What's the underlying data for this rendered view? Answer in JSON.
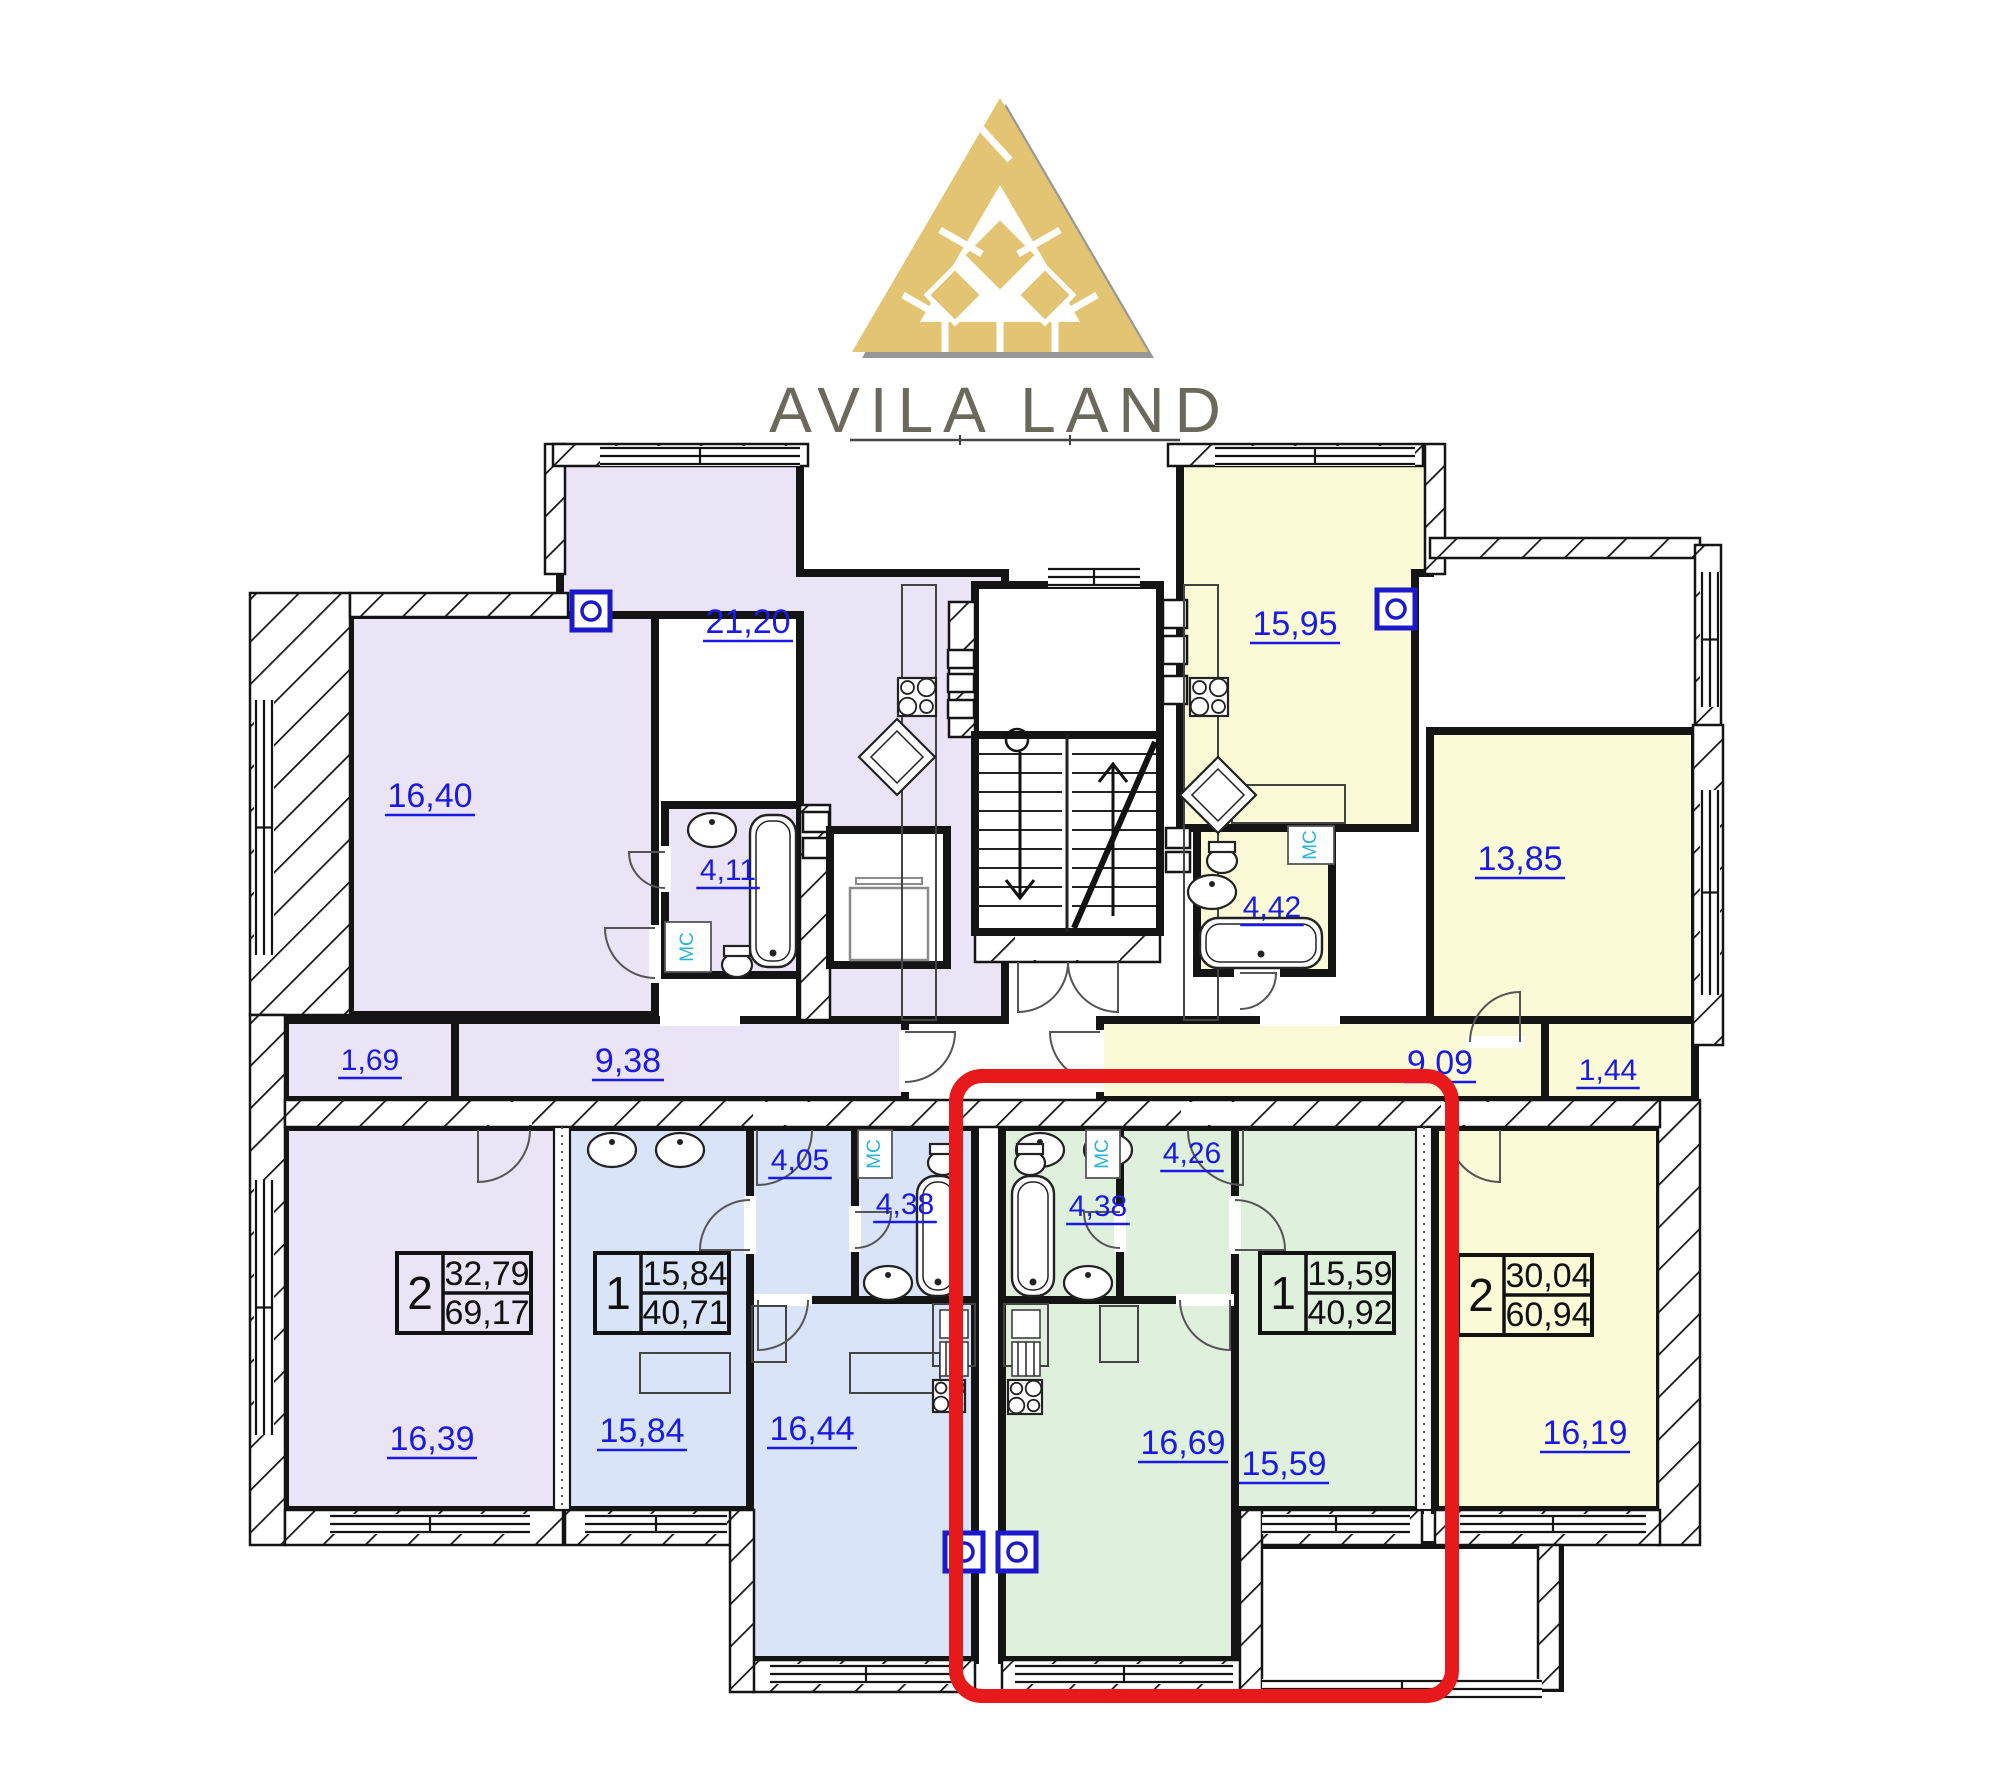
{
  "brand": {
    "name": "AVILA LAND"
  },
  "palette": {
    "purple": "#EBE3F6",
    "blue": "#D9E4F8",
    "green": "#DFF1DC",
    "yellow": "#FAFAD7",
    "white": "#FFFFFF",
    "wall": "#141414",
    "label_blue": "#1A1AE6",
    "mc_cyan": "#2BB3D8",
    "vent_blue": "#1A1ACC",
    "red": "#E8191B",
    "gold": "#E2C472",
    "gold_shadow": "#979797",
    "brand_text": "#6B695C",
    "fixture": "#2A2A2A"
  },
  "highlighted_apartment": {
    "rooms": "1",
    "living_area": "15,59",
    "total_area": "40,92",
    "color": "green"
  },
  "plan": {
    "rooms": [
      {
        "name": "kitchen-living-21-20",
        "fill": "purple",
        "poly": [
          [
            560,
            455
          ],
          [
            800,
            455
          ],
          [
            800,
            573
          ],
          [
            1005,
            573
          ],
          [
            1005,
            1020
          ],
          [
            800,
            1020
          ],
          [
            800,
            615
          ],
          [
            560,
            615
          ]
        ]
      },
      {
        "name": "kitchen-living-15-95",
        "fill": "yellow",
        "poly": [
          [
            1180,
            455
          ],
          [
            1430,
            455
          ],
          [
            1430,
            573
          ],
          [
            1415,
            573
          ],
          [
            1415,
            828
          ],
          [
            1180,
            828
          ]
        ]
      },
      {
        "name": "room-16-40",
        "fill": "purple",
        "rect": [
          350,
          615,
          305,
          400
        ]
      },
      {
        "name": "room-13-85",
        "fill": "yellow",
        "rect": [
          1430,
          731,
          265,
          311
        ]
      },
      {
        "name": "room-16-39",
        "fill": "purple",
        "rect": [
          285,
          1127,
          278,
          383
        ]
      },
      {
        "name": "room-16-19",
        "fill": "yellow",
        "rect": [
          1435,
          1127,
          225,
          383
        ]
      },
      {
        "name": "bedroom-15-84",
        "fill": "blue",
        "rect": [
          565,
          1127,
          185,
          383
        ]
      },
      {
        "name": "kitchen-16-44",
        "fill": "blue",
        "rect": [
          750,
          1127,
          225,
          533
        ]
      },
      {
        "name": "kitchen-16-69",
        "fill": "green",
        "rect": [
          1002,
          1127,
          233,
          533
        ]
      },
      {
        "name": "bedroom-15-59",
        "fill": "green",
        "rect": [
          1235,
          1127,
          185,
          383
        ]
      },
      {
        "name": "hall-9-38",
        "fill": "purple",
        "rect": [
          455,
          1020,
          450,
          80
        ]
      },
      {
        "name": "closet-1-69",
        "fill": "purple",
        "rect": [
          285,
          1020,
          170,
          80
        ]
      },
      {
        "name": "hall-9-09",
        "fill": "yellow",
        "rect": [
          1100,
          1020,
          445,
          80
        ]
      },
      {
        "name": "closet-1-44",
        "fill": "yellow",
        "rect": [
          1545,
          1020,
          150,
          80
        ]
      },
      {
        "name": "hall-4-05",
        "fill": "blue",
        "rect": [
          750,
          1127,
          105,
          173
        ]
      },
      {
        "name": "bath-4-11",
        "fill": "purple",
        "rect": [
          665,
          805,
          135,
          170
        ]
      },
      {
        "name": "bath-4-42",
        "fill": "yellow",
        "rect": [
          1197,
          828,
          135,
          145
        ]
      },
      {
        "name": "bath-4-38-blue",
        "fill": "blue",
        "rect": [
          855,
          1127,
          120,
          173
        ]
      },
      {
        "name": "bath-4-38-green",
        "fill": "green",
        "rect": [
          1002,
          1127,
          118,
          173
        ]
      },
      {
        "name": "hall-4-26",
        "fill": "green",
        "rect": [
          1120,
          1127,
          115,
          173
        ]
      },
      {
        "name": "vestibule",
        "fill": "white",
        "rect": [
          975,
          585,
          185,
          150
        ]
      },
      {
        "name": "stairwell",
        "fill": "white",
        "rect": [
          975,
          735,
          185,
          197
        ]
      },
      {
        "name": "terrace",
        "fill": "white",
        "rect": [
          1250,
          1545,
          310,
          143
        ]
      }
    ],
    "hatched_walls": [
      [
        250,
        593,
        100,
        422
      ],
      [
        250,
        1015,
        35,
        530
      ],
      [
        285,
        1510,
        278,
        35
      ],
      [
        350,
        593,
        218,
        24
      ],
      [
        545,
        444,
        20,
        130
      ],
      [
        553,
        444,
        255,
        22
      ],
      [
        1168,
        444,
        255,
        22
      ],
      [
        1425,
        444,
        20,
        130
      ],
      [
        949,
        602,
        26,
        135
      ],
      [
        1430,
        538,
        270,
        20
      ],
      [
        1695,
        545,
        26,
        188
      ],
      [
        1693,
        725,
        30,
        320
      ],
      [
        1658,
        1100,
        42,
        445
      ],
      [
        1435,
        1510,
        225,
        35
      ],
      [
        1250,
        1510,
        172,
        35
      ],
      [
        565,
        1510,
        187,
        35
      ],
      [
        753,
        1660,
        222,
        32
      ],
      [
        1002,
        1660,
        244,
        32
      ],
      [
        730,
        1510,
        24,
        182
      ],
      [
        1240,
        1510,
        22,
        182
      ],
      [
        1538,
        1545,
        22,
        145
      ],
      [
        285,
        1100,
        1375,
        27
      ],
      [
        975,
        932,
        185,
        30
      ],
      [
        800,
        805,
        30,
        215
      ]
    ],
    "door_gaps": [
      [
        472,
        1102,
        60,
        23
      ],
      [
        753,
        1102,
        62,
        23
      ],
      [
        1181,
        1102,
        62,
        23
      ],
      [
        1441,
        1102,
        62,
        23
      ],
      [
        1015,
        934,
        105,
        26
      ],
      [
        899,
        1030,
        10,
        62
      ],
      [
        1094,
        1030,
        10,
        62
      ],
      [
        660,
        1012,
        80,
        14
      ],
      [
        1260,
        1012,
        80,
        14
      ],
      [
        649,
        925,
        12,
        58
      ],
      [
        1466,
        1036,
        58,
        12
      ],
      [
        744,
        1196,
        12,
        58
      ],
      [
        1229,
        1196,
        12,
        58
      ],
      [
        754,
        1294,
        58,
        12
      ],
      [
        1176,
        1294,
        58,
        12
      ],
      [
        849,
        1206,
        12,
        46
      ],
      [
        1114,
        1206,
        12,
        46
      ],
      [
        659,
        846,
        12,
        46
      ],
      [
        1234,
        967,
        46,
        12
      ],
      [
        1030,
        729,
        70,
        12
      ]
    ],
    "windows": [
      {
        "o": "h",
        "x": 600,
        "y": 446,
        "len": 200
      },
      {
        "o": "h",
        "x": 1215,
        "y": 446,
        "len": 200
      },
      {
        "o": "h",
        "x": 1048,
        "y": 567,
        "len": 92
      },
      {
        "o": "h",
        "x": 330,
        "y": 1514,
        "len": 200
      },
      {
        "o": "h",
        "x": 585,
        "y": 1514,
        "len": 142
      },
      {
        "o": "h",
        "x": 770,
        "y": 1664,
        "len": 192
      },
      {
        "o": "h",
        "x": 1015,
        "y": 1664,
        "len": 218
      },
      {
        "o": "h",
        "x": 1262,
        "y": 1514,
        "len": 148
      },
      {
        "o": "h",
        "x": 1460,
        "y": 1514,
        "len": 186
      },
      {
        "o": "h",
        "x": 1262,
        "y": 1679,
        "len": 280
      },
      {
        "o": "v",
        "x": 254,
        "y": 700,
        "len": 255
      },
      {
        "o": "v",
        "x": 254,
        "y": 1180,
        "len": 255
      },
      {
        "o": "v",
        "x": 1700,
        "y": 790,
        "len": 205
      },
      {
        "o": "v",
        "x": 1700,
        "y": 572,
        "len": 135
      }
    ],
    "dotted_walls": [
      {
        "x": 554,
        "y": 1127,
        "h": 383
      },
      {
        "x": 1416,
        "y": 1127,
        "h": 383
      }
    ],
    "vents": [
      {
        "x": 572,
        "y": 592
      },
      {
        "x": 1377,
        "y": 590
      },
      {
        "x": 945,
        "y": 1533
      },
      {
        "x": 998,
        "y": 1533
      }
    ],
    "shafts": [
      [
        948,
        650,
        26,
        18
      ],
      [
        948,
        674,
        26,
        18
      ],
      [
        948,
        700,
        26,
        18
      ],
      [
        1163,
        600,
        24,
        28
      ],
      [
        1163,
        636,
        24,
        28
      ],
      [
        1163,
        676,
        24,
        28
      ],
      [
        803,
        812,
        26,
        20
      ],
      [
        803,
        838,
        26,
        20
      ],
      [
        1166,
        828,
        24,
        20
      ],
      [
        1166,
        852,
        24,
        20
      ]
    ],
    "stairs": {
      "rect": [
        975,
        735,
        185,
        197
      ],
      "divider_x": 1067,
      "flight1": [
        978,
        1062
      ],
      "flight2": [
        1072,
        1156
      ],
      "step_y0": 754,
      "step_dy": 19,
      "steps": 9,
      "diagonal": [
        1074,
        928,
        1155,
        742
      ],
      "arrow_down": [
        1020,
        752,
        1020,
        898
      ],
      "arrow_up": [
        1113,
        916,
        1113,
        764
      ],
      "circle": [
        1017,
        740,
        11
      ]
    },
    "elevator": {
      "outer": [
        830,
        830,
        117,
        135
      ],
      "car": [
        850,
        888,
        78,
        72
      ],
      "bar": [
        856,
        878,
        66,
        6
      ]
    },
    "furniture": [
      [
        902,
        585,
        34,
        435
      ],
      [
        1184,
        585,
        34,
        435
      ],
      [
        933,
        1304,
        42,
        62
      ],
      [
        1004,
        1304,
        44,
        62
      ],
      [
        752,
        1306,
        34,
        56
      ],
      [
        1100,
        1306,
        38,
        56
      ],
      [
        1232,
        785,
        113,
        38
      ],
      [
        640,
        1353,
        90,
        40
      ],
      [
        850,
        1353,
        90,
        40
      ]
    ],
    "sink_units": [
      [
        940,
        1310,
        28
      ],
      [
        1012,
        1310,
        28
      ]
    ],
    "stoves": [
      [
        898,
        678,
        38
      ],
      [
        1190,
        678,
        38
      ],
      [
        933,
        1380,
        32
      ],
      [
        1008,
        1380,
        34
      ]
    ],
    "diamonds": [
      [
        897,
        757,
        76
      ],
      [
        1218,
        795,
        76
      ]
    ],
    "tubs": [
      {
        "x": 750,
        "y": 815,
        "w": 46,
        "h": 152
      },
      {
        "x": 1200,
        "y": 918,
        "w": 122,
        "h": 50
      },
      {
        "x": 917,
        "y": 1176,
        "w": 42,
        "h": 120
      },
      {
        "x": 1012,
        "y": 1176,
        "w": 42,
        "h": 120
      }
    ],
    "sinks": [
      [
        712,
        830
      ],
      [
        1212,
        892
      ],
      [
        888,
        1283
      ],
      [
        1088,
        1283
      ],
      [
        612,
        1150
      ],
      [
        680,
        1150
      ],
      [
        1040,
        1150
      ],
      [
        1108,
        1150
      ]
    ],
    "toilets": [
      [
        737,
        952
      ],
      [
        1222,
        848
      ],
      [
        943,
        1150
      ],
      [
        1030,
        1150
      ]
    ],
    "mc_boxes": [
      {
        "x": 665,
        "y": 922,
        "w": 46,
        "h": 50
      },
      {
        "x": 1288,
        "y": 826,
        "w": 46,
        "h": 38
      },
      {
        "x": 858,
        "y": 1130,
        "w": 34,
        "h": 48
      },
      {
        "x": 1086,
        "y": 1130,
        "w": 34,
        "h": 48
      }
    ],
    "mc_text": "МС",
    "doors": [
      "M1018,962 L1018,1012 A50,50 0 0 0 1068,962",
      "M1118,962 L1118,1012 A50,50 0 0 1 1068,962",
      "M905,1032 L955,1032 A50,50 0 0 1 905,1082",
      "M1100,1032 L1050,1032 A50,50 0 0 0 1100,1082",
      "M757,1130 L757,1185 A55,55 0 0 0 812,1130",
      "M1243,1130 L1243,1185 A55,55 0 0 1 1188,1130",
      "M478,1130 L478,1182 A52,52 0 0 0 530,1130",
      "M1500,1130 L1500,1182 A52,52 0 0 1 1448,1130",
      "M655,928 L605,928 A50,50 0 0 0 655,978",
      "M1520,1042 L1520,992 A50,50 0 0 0 1470,1042",
      "M750,1250 L700,1250 A50,50 0 0 1 750,1200",
      "M1235,1250 L1285,1250 A50,50 0 0 0 1235,1200",
      "M855,1212 L891,1212 A36,36 0 0 1 855,1248",
      "M1120,1212 L1084,1212 A36,36 0 0 0 1120,1248",
      "M665,852 L629,852 A36,36 0 0 0 665,888",
      "M1240,973 L1276,973 A36,36 0 0 1 1240,1009",
      "M758,1300 L758,1350 A50,50 0 0 0 808,1300",
      "M1230,1300 L1230,1350 A50,50 0 0 1 1180,1300"
    ],
    "porch_line": [
      850,
      440,
      1180,
      440
    ],
    "area_labels": [
      {
        "t": "21,20",
        "x": 748,
        "y": 633,
        "fs": 34
      },
      {
        "t": "16,40",
        "x": 430,
        "y": 807,
        "fs": 34
      },
      {
        "t": "4,11",
        "x": 728,
        "y": 880,
        "fs": 30
      },
      {
        "t": "1,69",
        "x": 370,
        "y": 1070,
        "fs": 30
      },
      {
        "t": "9,38",
        "x": 628,
        "y": 1072,
        "fs": 34
      },
      {
        "t": "15,95",
        "x": 1295,
        "y": 635,
        "fs": 34
      },
      {
        "t": "4,42",
        "x": 1272,
        "y": 917,
        "fs": 30
      },
      {
        "t": "13,85",
        "x": 1520,
        "y": 870,
        "fs": 34
      },
      {
        "t": "9,09",
        "x": 1440,
        "y": 1074,
        "fs": 34
      },
      {
        "t": "1,44",
        "x": 1608,
        "y": 1080,
        "fs": 30
      },
      {
        "t": "16,39",
        "x": 432,
        "y": 1450,
        "fs": 34
      },
      {
        "t": "15,84",
        "x": 642,
        "y": 1442,
        "fs": 34
      },
      {
        "t": "4,05",
        "x": 800,
        "y": 1170,
        "fs": 30
      },
      {
        "t": "4,38",
        "x": 905,
        "y": 1214,
        "fs": 30
      },
      {
        "t": "4,38",
        "x": 1098,
        "y": 1216,
        "fs": 30
      },
      {
        "t": "4,26",
        "x": 1192,
        "y": 1163,
        "fs": 30
      },
      {
        "t": "16,44",
        "x": 812,
        "y": 1440,
        "fs": 34
      },
      {
        "t": "16,69",
        "x": 1183,
        "y": 1454,
        "fs": 34
      },
      {
        "t": "15,59",
        "x": 1284,
        "y": 1475,
        "fs": 34
      },
      {
        "t": "16,19",
        "x": 1585,
        "y": 1444,
        "fs": 34
      }
    ],
    "info_boxes": [
      {
        "apartment": "purple-2-room",
        "x": 397,
        "y": 1253,
        "rooms": "2",
        "living": "32,79",
        "total": "69,17"
      },
      {
        "apartment": "blue-1-room",
        "x": 595,
        "y": 1253,
        "rooms": "1",
        "living": "15,84",
        "total": "40,71"
      },
      {
        "apartment": "green-1-room",
        "x": 1260,
        "y": 1253,
        "rooms": "1",
        "living": "15,59",
        "total": "40,92"
      },
      {
        "apartment": "yellow-2-room",
        "x": 1458,
        "y": 1255,
        "rooms": "2",
        "living": "30,04",
        "total": "60,94"
      }
    ],
    "highlight": {
      "x": 956,
      "y": 1076,
      "w": 496,
      "h": 620,
      "rx": 26,
      "stroke_width": 14
    }
  }
}
